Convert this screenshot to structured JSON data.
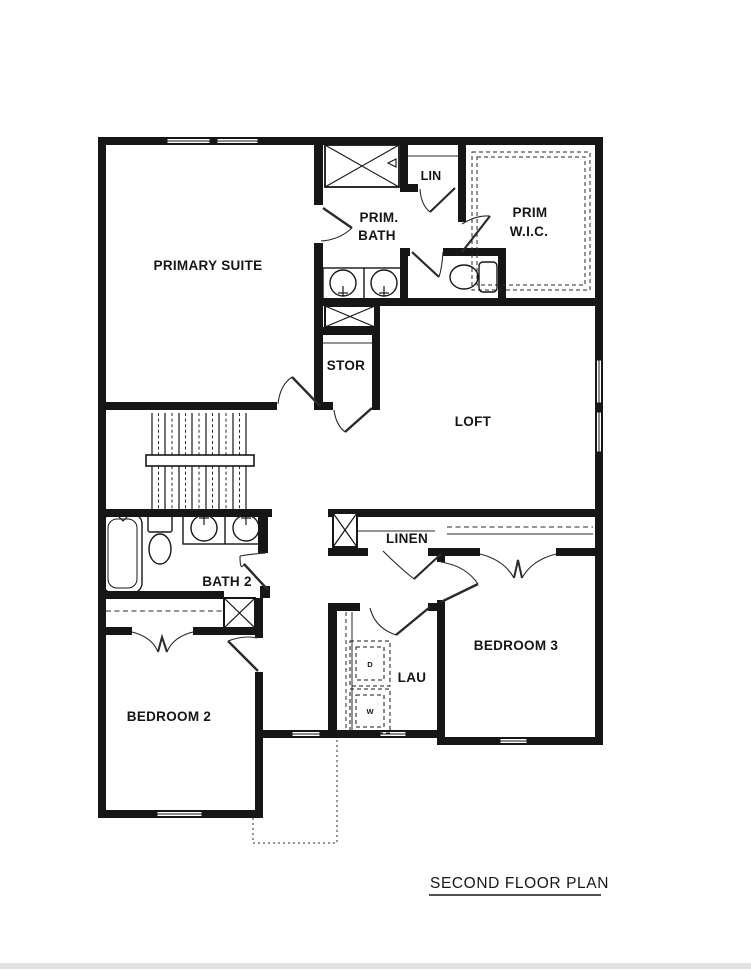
{
  "title": "SECOND FLOOR PLAN",
  "colors": {
    "walls": "#161616",
    "background": "#ffffff",
    "thin_line": "#2a2a2a",
    "bottom_strip": "#e0e0e0"
  },
  "rooms": {
    "primary_suite": "PRIMARY SUITE",
    "prim_bath_line1": "PRIM.",
    "prim_bath_line2": "BATH",
    "lin": "LIN",
    "prim_wic_line1": "PRIM",
    "prim_wic_line2": "W.I.C.",
    "stor": "STOR",
    "loft": "LOFT",
    "bath2": "BATH 2",
    "linen": "LINEN",
    "lau": "LAU",
    "bedroom2": "BEDROOM 2",
    "bedroom3": "BEDROOM 3"
  },
  "appliances": {
    "dryer": "D",
    "washer": "W"
  },
  "fixtures": [
    "shower",
    "bathtub",
    "toilet",
    "double-vanity",
    "stairs",
    "washer",
    "dryer",
    "closet-rods",
    "wic-shelving"
  ]
}
